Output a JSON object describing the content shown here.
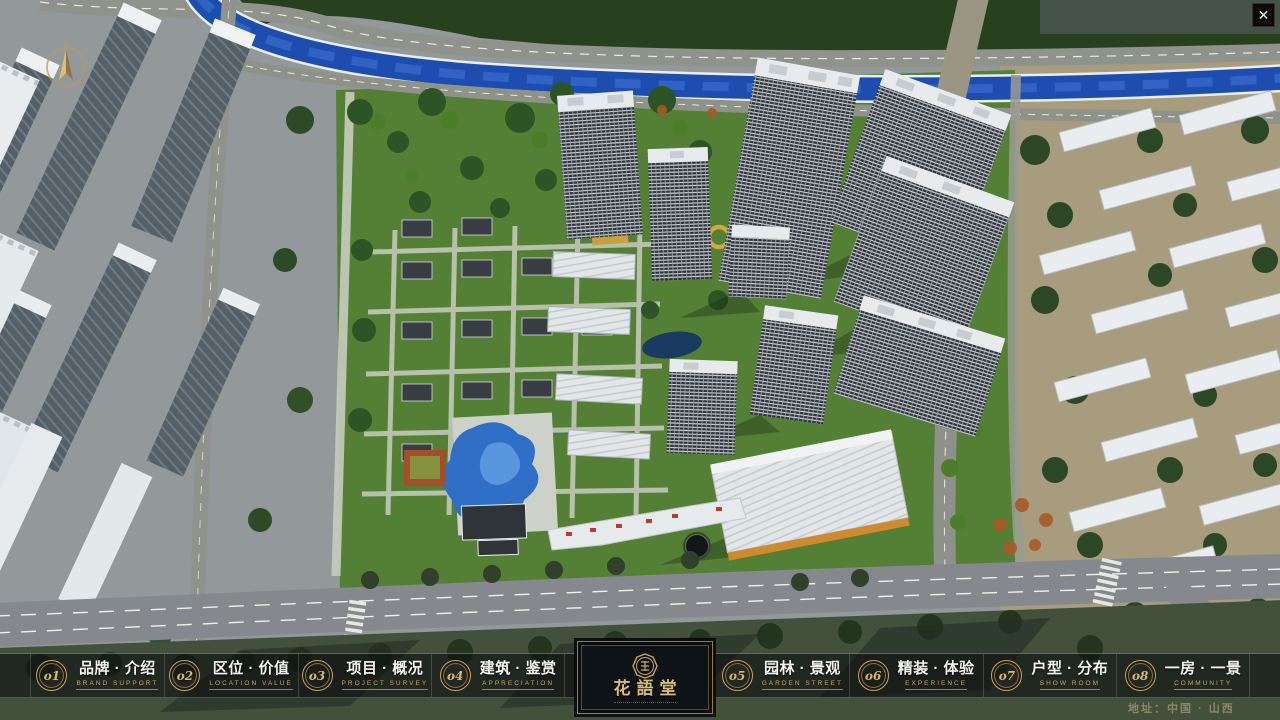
{
  "window": {
    "close_glyph": "✕"
  },
  "brand": {
    "name": "花語堂"
  },
  "nav": {
    "items": [
      {
        "num": "o1",
        "label": "品牌 · 介绍",
        "sub": "BRAND SUPPORT"
      },
      {
        "num": "o2",
        "label": "区位 · 价值",
        "sub": "LOCATION VALUE"
      },
      {
        "num": "o3",
        "label": "项目 · 概况",
        "sub": "PROJECT SURVEY"
      },
      {
        "num": "o4",
        "label": "建筑 · 鉴赏",
        "sub": "APPRECIATION"
      },
      {
        "num": "o5",
        "label": "园林 · 景观",
        "sub": "GARDEN STREET"
      },
      {
        "num": "o6",
        "label": "精装 · 体验",
        "sub": "EXPERIENCE"
      },
      {
        "num": "o7",
        "label": "户型 · 分布",
        "sub": "SHOW ROOM"
      },
      {
        "num": "o8",
        "label": "一房 · 一景",
        "sub": "COMMUNITY"
      }
    ]
  },
  "footer": {
    "address": "地址：中国 · 山西"
  },
  "theme": {
    "gold": "#c9a45c",
    "gold_deep": "#8a7240",
    "bar_bg": "rgba(10,12,15,0.58)",
    "panel_bg": "#0e1318",
    "address": "#8d8768",
    "river": "#1d4dae",
    "community_green": "#538034",
    "road_grey": "#85888c",
    "city_tan": "#a79c7e"
  }
}
